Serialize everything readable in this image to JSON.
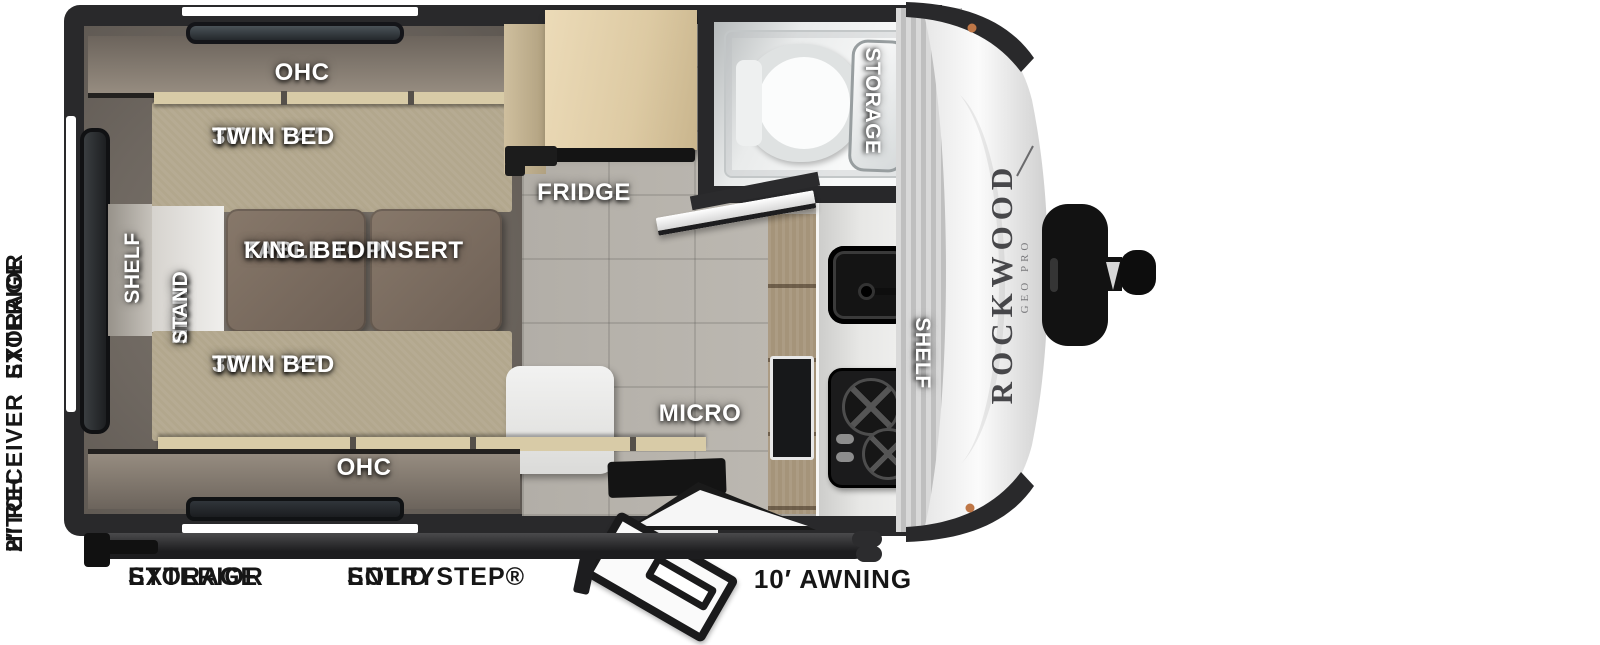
{
  "plan": {
    "bedroom": {
      "ohc_top": "OHC",
      "ohc_bottom": "OHC",
      "twin_top_line1": "30″ × 74″",
      "twin_top_line2": "TWIN BED",
      "twin_bottom_line1": "30″ × 74″",
      "twin_bottom_line2": "TWIN BED",
      "table_line1": "TABLE TOP/",
      "table_line2": "KING BED INSERT",
      "night_stand_line1": "NIGHT",
      "night_stand_line2": "STAND",
      "shelf": "SHELF"
    },
    "galley": {
      "fridge": "FRIDGE",
      "micro": "MICRO",
      "shelf": "SHELF"
    },
    "bath": {
      "storage": "STORAGE"
    },
    "brand": {
      "name": "ROCKWOOD",
      "series": "GEO PRO"
    },
    "exterior": {
      "hitch_line1": "2″ RECEIVER",
      "hitch_line2": "HITCH",
      "rear_storage_line1": "EXTERIOR",
      "rear_storage_line2": "STORAGE",
      "storage_line1": "EXTERIOR",
      "storage_line2": "STORAGE",
      "entry_line1": "SOLID STEP®",
      "entry_line2": "ENTRY",
      "awning": "10′ AWNING"
    },
    "colors": {
      "wall": "#29292b",
      "carpet": "#6e6760",
      "tile": "#b7b3ac",
      "mattress": "#b2a78d",
      "table_wood": "#7c6c5f",
      "cabinet_wood": "#d8cba7",
      "fridge_wood": "#e0d0ab",
      "counter": "#e6e6e4",
      "appliance_black": "#151515",
      "brand_text": "#47474a",
      "interior_label": "#ffffff",
      "exterior_label": "#161616"
    }
  }
}
